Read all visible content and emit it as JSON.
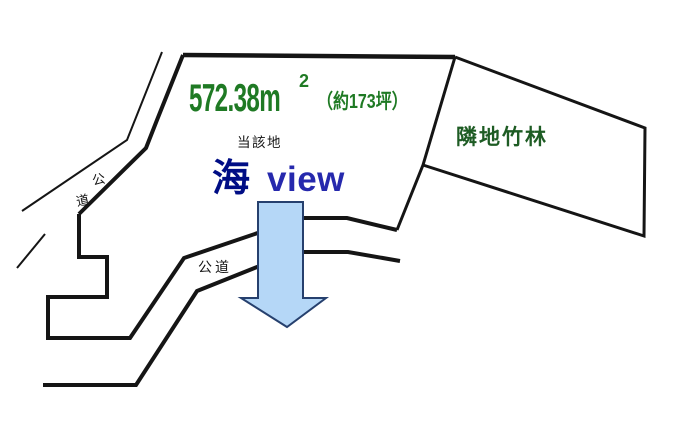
{
  "diagram": {
    "area_label": {
      "value": "572.38",
      "unit": "m",
      "superscript": "2",
      "tsubo": "（約173坪）",
      "color": "#1f7a24"
    },
    "subject_site_label": "当該地",
    "sea_view": {
      "kanji": "海",
      "latin": "view",
      "kanji_color": "#000d85",
      "latin_color": "#2629ad"
    },
    "neighbor_label": {
      "text": "隣地竹林",
      "color": "#1e5c24"
    },
    "public_road_label": "公道",
    "public_road_vertical_label": {
      "char1": "公",
      "char2": "道"
    },
    "arrow": {
      "fill": "#b5d7f7",
      "stroke": "#26406e"
    },
    "line_color": "#151515",
    "background": "#ffffff"
  }
}
